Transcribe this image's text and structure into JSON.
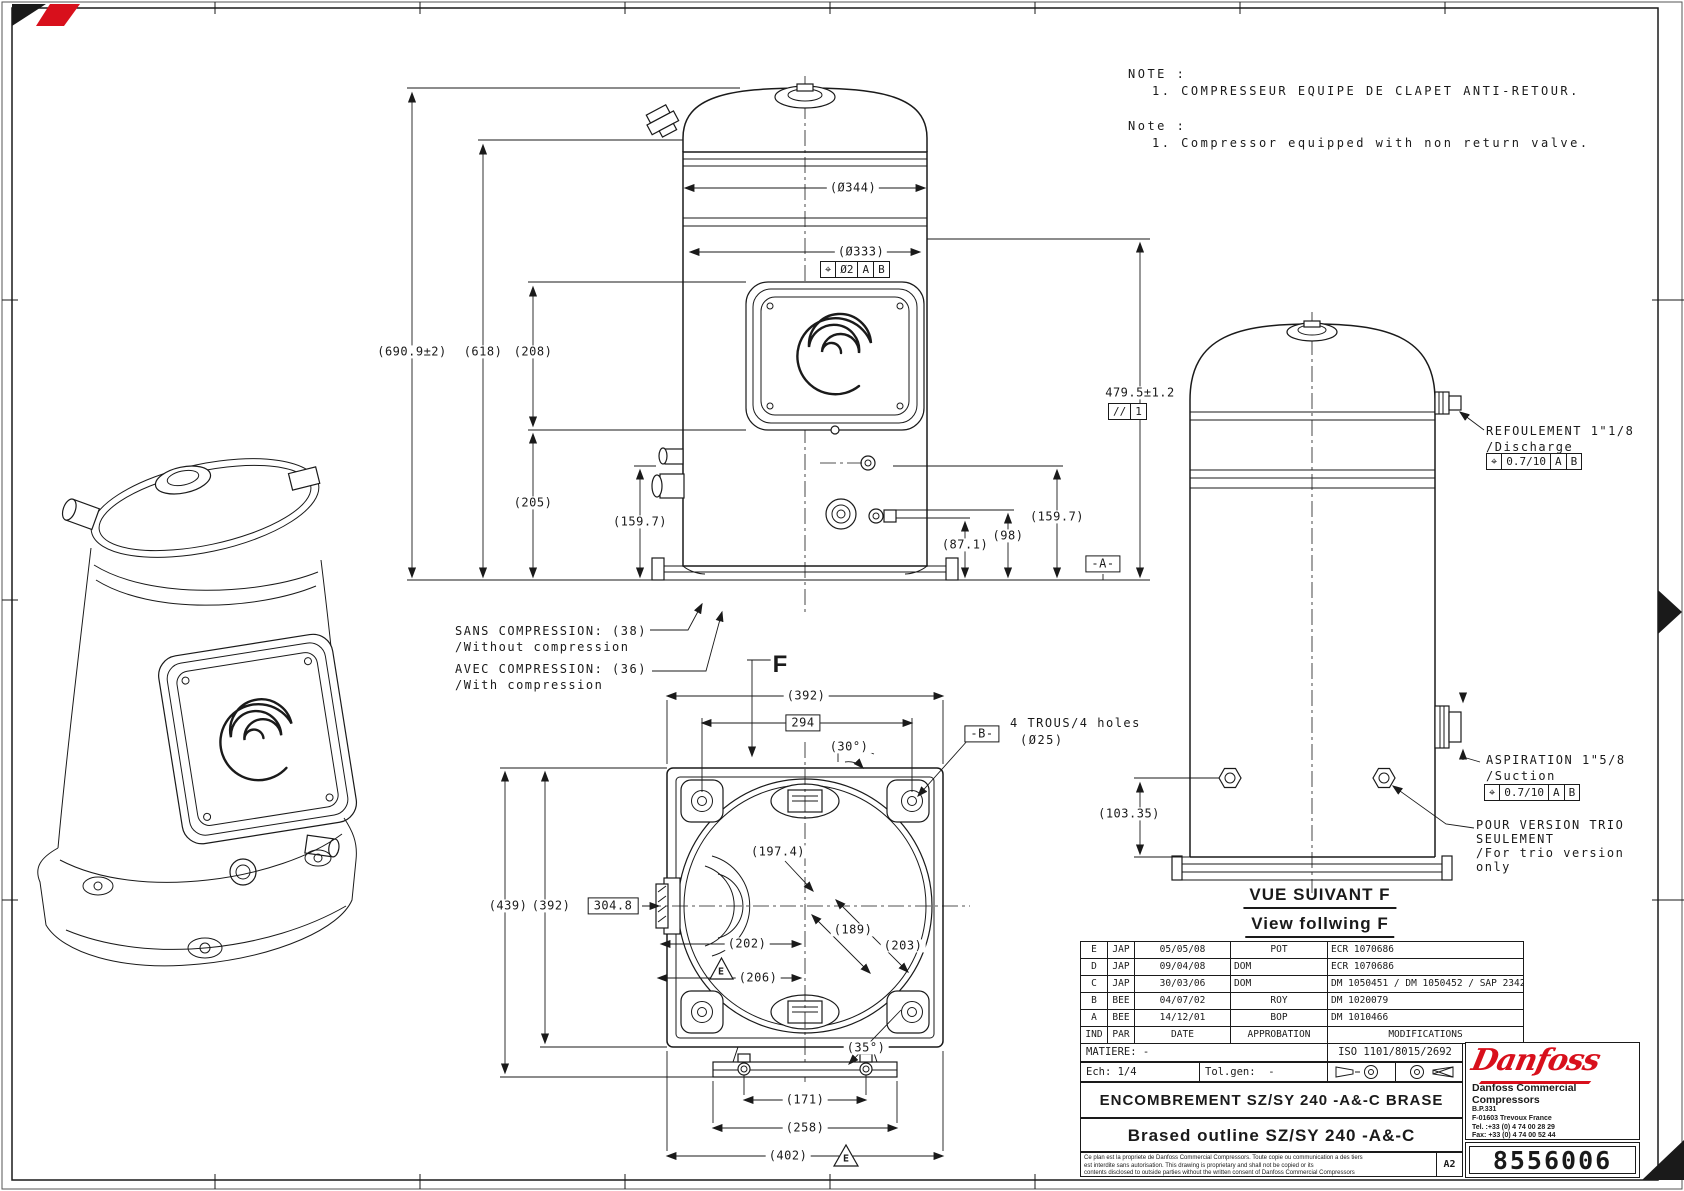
{
  "notes": {
    "fr_title": "NOTE :",
    "fr_line1": "1. COMPRESSEUR EQUIPE DE CLAPET ANTI-RETOUR.",
    "en_title": "Note :",
    "en_line1": "1. Compressor equipped with non return valve."
  },
  "front": {
    "dia_outer": "(Ø344)",
    "dia_inner": "(Ø333)",
    "pos_sym": "⌖",
    "pos_val": "Ø2",
    "pos_a": "A",
    "pos_b": "B",
    "h_total": "(690.9±2)",
    "h_shell": "(618)",
    "h_plate": "(208)",
    "h_205": "(205)",
    "h_159_left": "(159.7)",
    "h_479": "479.5±1.2",
    "par_sym": "//",
    "par_val": "1",
    "h_159_right": "(159.7)",
    "h_98": "(98)",
    "h_87": "(87.1)",
    "datum_a": "-A-",
    "sans_fr": "SANS COMPRESSION: (38)",
    "sans_en": "/Without compression",
    "avec_fr": "AVEC COMPRESSION: (36)",
    "avec_en": "/With compression"
  },
  "bottom": {
    "view_f": "F",
    "w392": "(392)",
    "w294": "294",
    "a30": "(30°)",
    "datum_b": "-B-",
    "holes_fr": "4 TROUS/4 holes",
    "holes_dia": "(Ø25)",
    "h439": "(439)",
    "h392": "(392)",
    "h3048": "304.8",
    "d1974": "(197.4)",
    "w202": "(202)",
    "d189": "(189)",
    "d203": "(203)",
    "w206": "(206)",
    "datum_e": "E",
    "a35": "(35°)",
    "w171": "(171)",
    "w258": "(258)",
    "w402": "(402)"
  },
  "side": {
    "disch_fr": "REFOULEMENT 1\"1/8",
    "disch_en": "/Discharge",
    "disch_sym": "⌖",
    "disch_val": "0.7/10",
    "disch_a": "A",
    "disch_b": "B",
    "suct_fr": "ASPIRATION 1\"5/8",
    "suct_en": "/Suction",
    "suct_sym": "⌖",
    "suct_val": "0.7/10",
    "suct_a": "A",
    "suct_b": "B",
    "trio1": "POUR VERSION TRIO",
    "trio2": "SEULEMENT",
    "trio3": "/For trio version",
    "trio4": "only",
    "h103": "(103.35)"
  },
  "titles": {
    "vue_fr": "VUE SUIVANT F",
    "vue_en": "View follwing F"
  },
  "revisions": {
    "header": {
      "ind": "IND",
      "par": "PAR",
      "date": "DATE",
      "appro": "APPROBATION",
      "mod": "MODIFICATIONS"
    },
    "rows": [
      {
        "ind": "E",
        "par": "JAP",
        "date": "05/05/08",
        "appro": "POT",
        "mod": "ECR 1070686"
      },
      {
        "ind": "D",
        "par": "JAP",
        "date": "09/04/08",
        "appro": "DOM",
        "mod": "ECR 1070686"
      },
      {
        "ind": "C",
        "par": "JAP",
        "date": "30/03/06",
        "appro": "DOM",
        "mod": "DM 1050451 / DM 1050452 / SAP 23428"
      },
      {
        "ind": "B",
        "par": "BEE",
        "date": "04/07/02",
        "appro": "ROY",
        "mod": "DM 1020079"
      },
      {
        "ind": "A",
        "par": "BEE",
        "date": "14/12/01",
        "appro": "BOP",
        "mod": "DM 1010466"
      }
    ]
  },
  "block": {
    "matiere": "MATIERE: -",
    "iso": "ISO 1101/8015/2692",
    "ech": "Ech: 1/4",
    "tol_label": "Tol.gen:",
    "tol_value": "-",
    "title_fr": "ENCOMBREMENT SZ/SY 240 -A&-C BRASE",
    "title_en": "Brased outline SZ/SY 240 -A&-C",
    "legal1": "Ce plan est la propriete de Danfoss Commercial Compressors. Toute copie ou communication a des tiers",
    "legal2": "est interdite sans autorisation. This drawing is proprietary and shall not be copied or its",
    "legal3": "contents disclosed to outside parties without the written consent of Danfoss Commercial Compressors",
    "format": "A2",
    "number": "8556006"
  },
  "company": {
    "logo": "Danfoss",
    "line1": "Danfoss Commercial",
    "line2": "Compressors",
    "line3": "B.P.331",
    "line4": "F-01603 Trevoux France",
    "line5": "Tel. :+33 (0) 4 74 00 28 29",
    "line6": "Fax: +33 (0) 4 74 00 52 44"
  }
}
